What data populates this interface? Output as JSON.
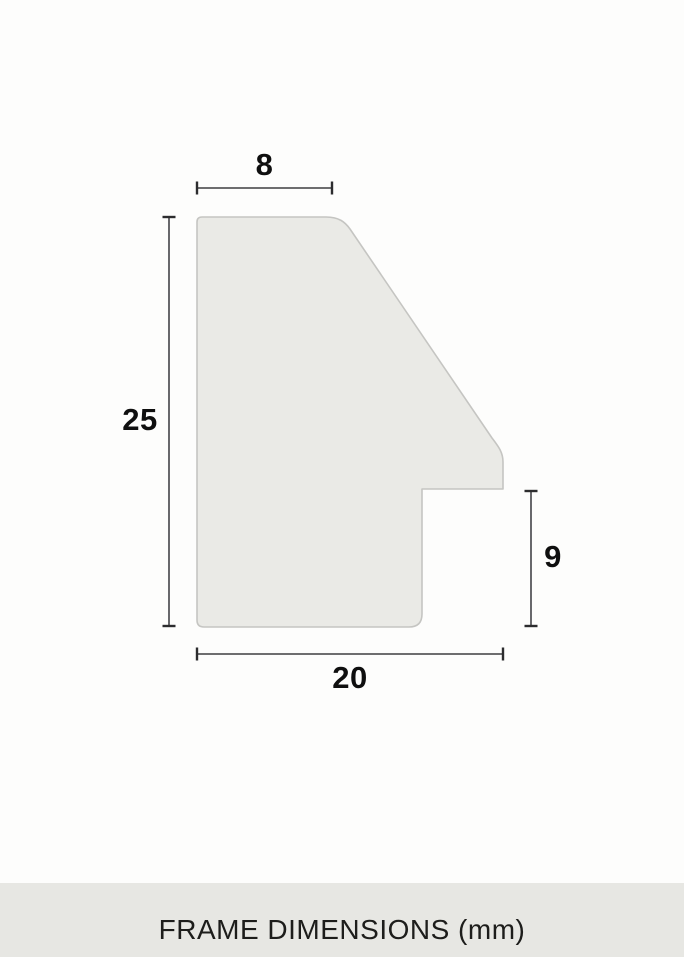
{
  "diagram": {
    "description": "frame-profile-cross-section",
    "dimensions": {
      "top_width": "8",
      "left_height": "25",
      "right_height": "9",
      "bottom_width": "20"
    },
    "unit": "mm",
    "colors": {
      "shape_fill": "#eaeae6",
      "shape_stroke": "#c5c5c2",
      "dim_line": "#58585b",
      "dim_tick": "#2c2c2e",
      "label_text": "#0f0f0f"
    }
  },
  "footer": {
    "caption": "FRAME DIMENSIONS (mm)",
    "background": "#e7e7e3",
    "text_color": "#1d1d1b"
  }
}
